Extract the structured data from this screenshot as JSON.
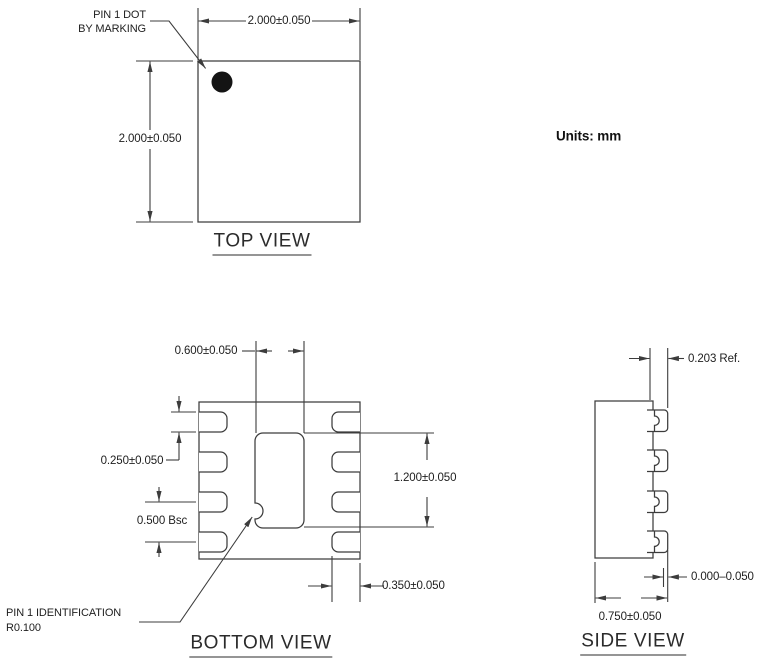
{
  "drawing": {
    "units_label": "Units: mm",
    "top_view": {
      "title": "TOP VIEW",
      "pin1_label_line1": "PIN 1 DOT",
      "pin1_label_line2": "BY MARKING",
      "dim_width": "2.000±0.050",
      "dim_height": "2.000±0.050"
    },
    "bottom_view": {
      "title": "BOTTOM VIEW",
      "dim_pad_width": "0.600±0.050",
      "dim_pin_length": "0.250±0.050",
      "dim_pitch": "0.500 Bsc",
      "dim_pad_height": "1.200±0.050",
      "dim_pin_width": "0.350±0.050",
      "pin1_id_line1": "PIN 1 IDENTIFICATION",
      "pin1_id_line2": "R0.100"
    },
    "side_view": {
      "title": "SIDE VIEW",
      "dim_lead_thickness": "0.203 Ref.",
      "dim_lead_pullback": "0.000–0.050",
      "dim_body_height": "0.750±0.050"
    },
    "colors": {
      "line": "#3c3c3c",
      "text": "#1e1e1e"
    }
  }
}
